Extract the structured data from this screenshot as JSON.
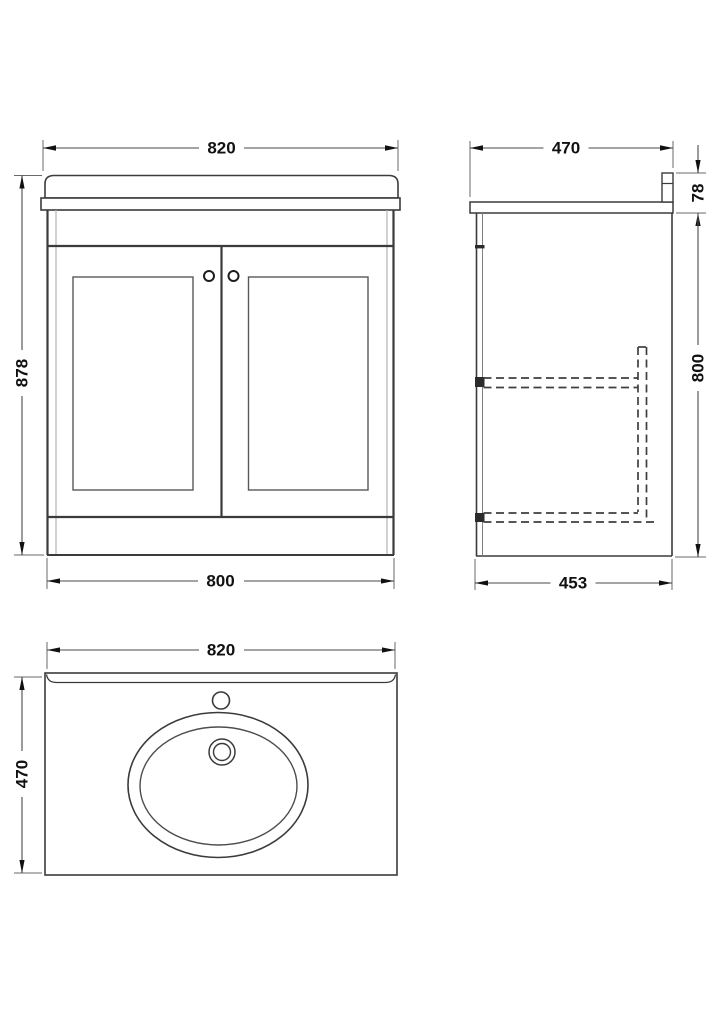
{
  "drawing": {
    "subject": "Bathroom vanity unit with basin - technical dimension drawing",
    "units": "mm",
    "colors": {
      "outline": "#3b3b3b",
      "light_line": "#b3b3b3",
      "dimension_line": "#4a4a4a",
      "text": "#111111",
      "background": "#ffffff"
    },
    "views": {
      "front": {
        "label": "front elevation",
        "overall_width": "820",
        "overall_height": "878",
        "cabinet_width": "800"
      },
      "side": {
        "label": "side elevation",
        "overall_depth": "470",
        "worktop_and_upstand_height": "78",
        "cabinet_height": "800",
        "cabinet_depth": "453"
      },
      "plan": {
        "label": "plan view",
        "overall_width": "820",
        "overall_depth": "470"
      }
    }
  }
}
